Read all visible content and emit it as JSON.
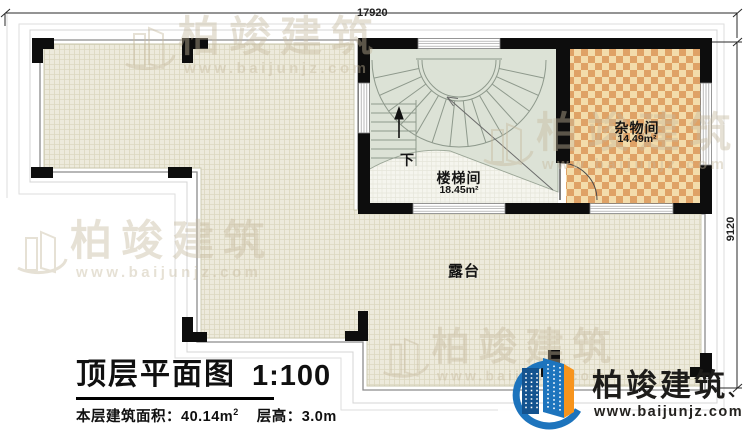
{
  "dimensions": {
    "top": "17920",
    "right": "9120"
  },
  "rooms": {
    "stairwell": {
      "name": "楼梯间",
      "area": "18.45m²",
      "down_label": "下"
    },
    "storage": {
      "name": "杂物间",
      "area": "14.49m²"
    },
    "terrace": {
      "name": "露台"
    }
  },
  "title_block": {
    "title": "顶层平面图",
    "scale": "1:100",
    "area_label": "本层建筑面积：",
    "area_value": "40.14m",
    "area_sup": "2",
    "height_text": "层高：3.0m"
  },
  "brand": {
    "name": "柏竣建筑",
    "suffix": "、",
    "url": "www.baijunjz.com"
  },
  "watermark": {
    "name": "柏竣建筑",
    "url": "www.baijunjz.com"
  },
  "colors": {
    "wall": "#0d0d0d",
    "floor": "#edeadc",
    "floor_grid_line": "#dcd8c0",
    "checker_light": "#f3dcab",
    "checker_dark": "#dfa266",
    "stair_fill": "#dce2d6",
    "brand_blue": "#1d74bd",
    "brand_navy": "#14538f",
    "brand_orange": "#f7941d"
  }
}
